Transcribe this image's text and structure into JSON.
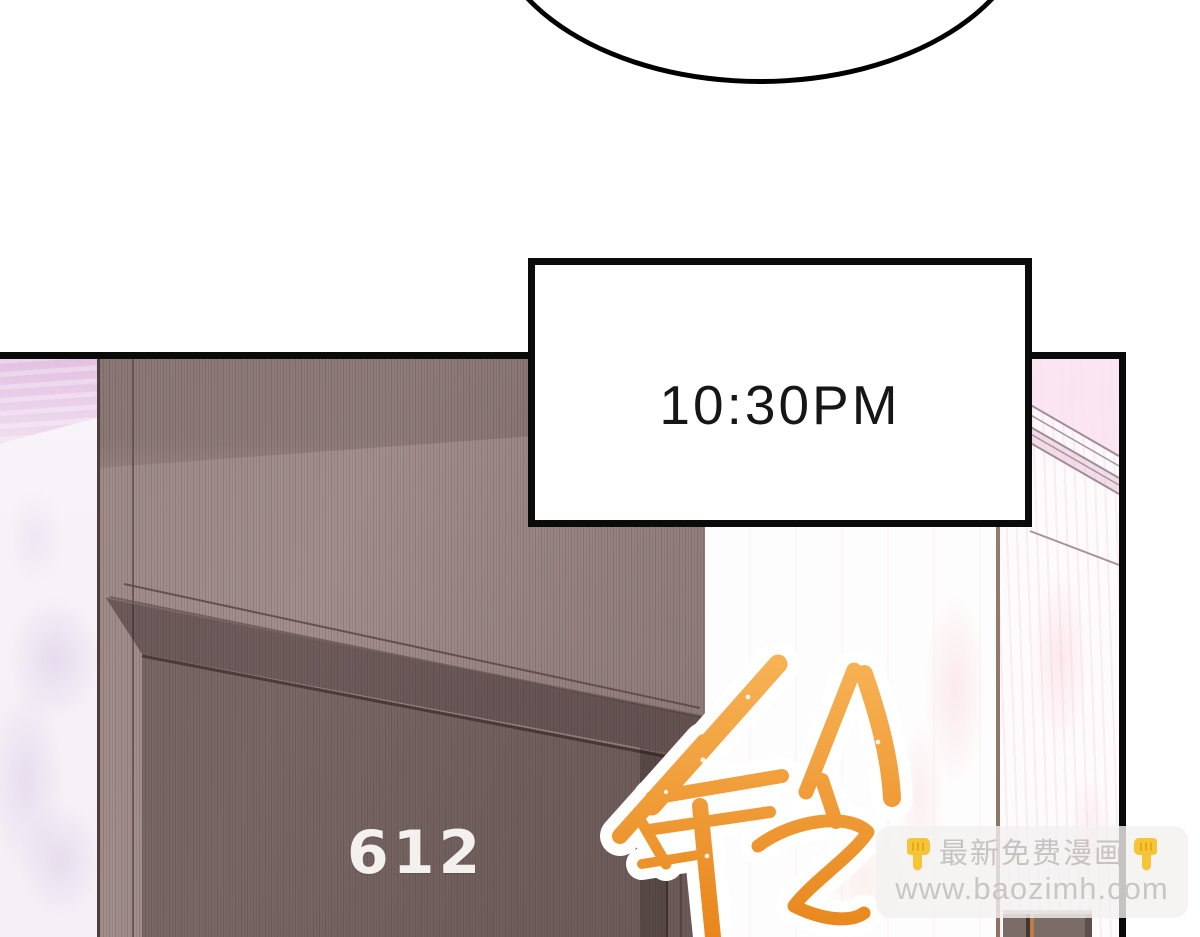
{
  "page_type": "comic panel",
  "caption_box": {
    "time_text": "10:30PM"
  },
  "scene": {
    "door_number": "612",
    "sfx_text": "铃",
    "sfx_color_top": "#f7b254",
    "sfx_color_bottom": "#e8861c"
  },
  "watermark": {
    "title": "最新免费漫画",
    "url": "www.baozimh.com",
    "finger_icon": "👇",
    "text_color": "#c7c3c1",
    "finger_color": "#f6c437"
  },
  "colors": {
    "panel_border": "#0a0a0a",
    "wall_wood": "#9d8a89",
    "door_wood": "#7d6b69",
    "marble_left": "#eed5ec",
    "marble_right": "#fdf4fa",
    "door_number_color": "#f3f0ed"
  }
}
